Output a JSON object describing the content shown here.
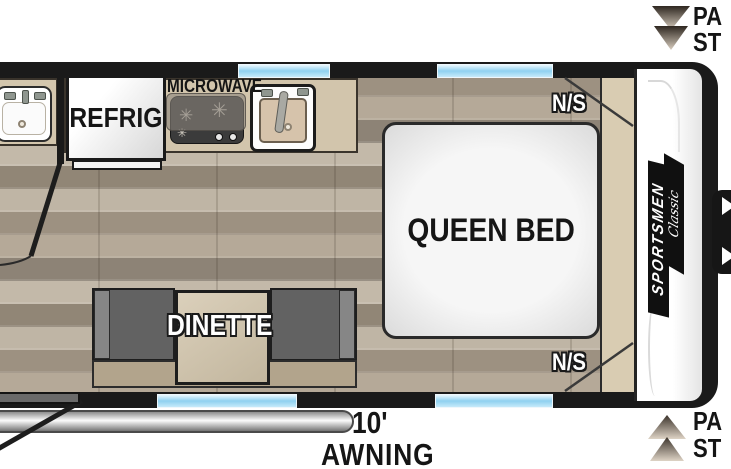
{
  "diagram": {
    "type": "rv-travel-trailer-floorplan",
    "kitchen": {
      "microwave_label": "MICROWAVE",
      "refrigerator_label": "REFRIG"
    },
    "bedroom": {
      "bed_label": "QUEEN BED",
      "nightstand_top_label": "N/S",
      "nightstand_bottom_label": "N/S"
    },
    "dinette": {
      "label": "DINETTE"
    },
    "awning": {
      "length": "10'",
      "label": "AWNING"
    },
    "pass_thru_top": {
      "line1": "PA",
      "line2": "ST"
    },
    "pass_thru_bottom": {
      "line1": "PA",
      "line2": "ST"
    },
    "brand": {
      "name": "SPORTSMEN",
      "series": "Classic"
    },
    "icons": {
      "pass_thru_top": "double-arrow-down",
      "pass_thru_bottom": "double-arrow-up",
      "burner_glyph": "✳",
      "faucet": "faucet",
      "drain": "drain"
    },
    "colors": {
      "wall": "#1a1a1a",
      "floor_wood": "#aca08f",
      "window_blue": "#8fd1f0",
      "counter_tan": "#d2c5ac",
      "bench_gray": "#626262",
      "bed_white": "#f4f4f4",
      "front_cap": "#ffffff",
      "awning_silver": "#c9c9c9",
      "storage_tan": "#d9ccb2"
    }
  }
}
